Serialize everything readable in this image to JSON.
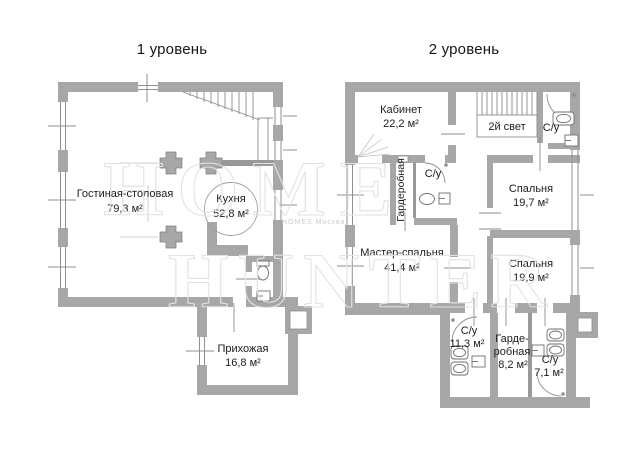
{
  "page": {
    "background": "#ffffff"
  },
  "colors": {
    "wall": "#a7a7a7",
    "wall_dark": "#999999",
    "thin_line": "#8c8c8c",
    "text": "#1d1d1d",
    "watermark": "#e2e2e2"
  },
  "plans": [
    {
      "title": "1 уровень",
      "rooms": [
        {
          "name": "Гостиная-столовая",
          "area": "79,3 м²"
        },
        {
          "name": "Кухня",
          "area": "52,8 м²"
        },
        {
          "name": "Прихожая",
          "area": "16,8 м²"
        }
      ]
    },
    {
      "title": "2 уровень",
      "rooms": [
        {
          "name": "Кабинет",
          "area": "22,2 м²"
        },
        {
          "name": "2й свет"
        },
        {
          "name": "С/у"
        },
        {
          "name": "Гардеробная"
        },
        {
          "name": "С/у"
        },
        {
          "name": "Спальня",
          "area": "19,7 м²"
        },
        {
          "name": "Мастер-спальня",
          "area": "41,4 м²"
        },
        {
          "name": "Спальня",
          "area": "19,9 м²"
        },
        {
          "name": "С/у",
          "area": "11,3 м²"
        },
        {
          "name": "Гардеробная",
          "name_line1": "Гарде-",
          "name_line2": "робная",
          "area": "8,2 м²"
        },
        {
          "name": "С/у",
          "area": "7,1 м²"
        }
      ]
    }
  ],
  "watermark": {
    "line1": "HOME",
    "line2": "HUNTER",
    "small": "HOMES Москва"
  }
}
